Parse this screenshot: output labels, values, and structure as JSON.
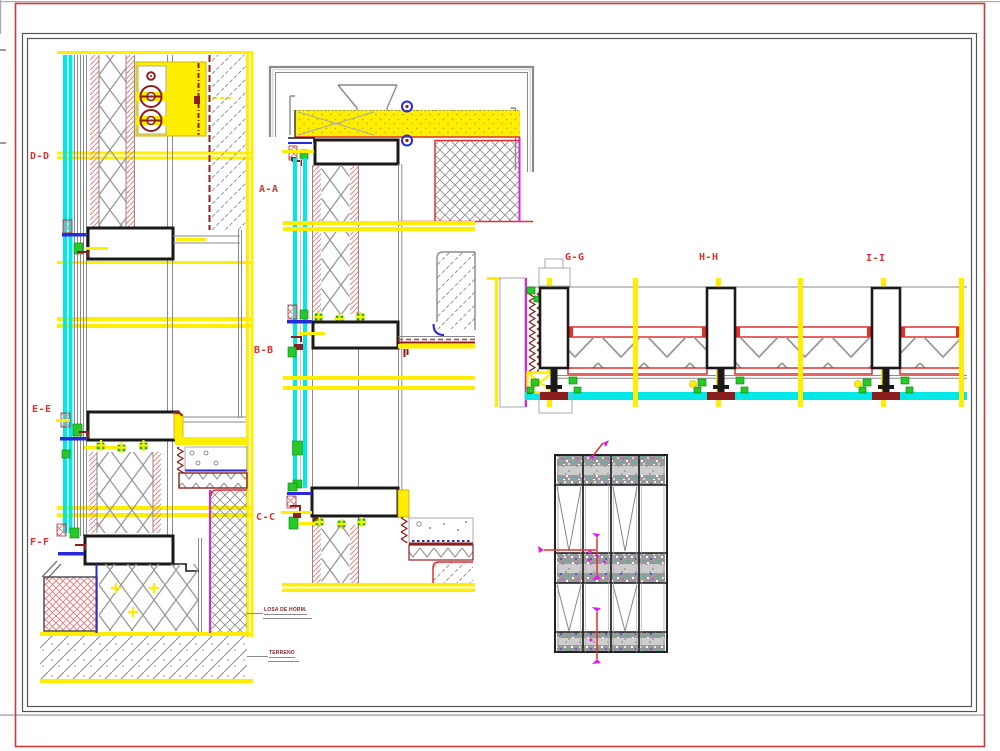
{
  "sheet": {
    "background": "#ffffff"
  },
  "frame": {
    "outer": "#cc3a3a",
    "inner": "#555555"
  },
  "section_labels": [
    {
      "id": "dd",
      "text": "D-D"
    },
    {
      "id": "aa",
      "text": "A-A"
    },
    {
      "id": "ee",
      "text": "E-E"
    },
    {
      "id": "bb",
      "text": "B-B"
    },
    {
      "id": "ff",
      "text": "F-F"
    },
    {
      "id": "cc",
      "text": "C-C"
    },
    {
      "id": "gg",
      "text": "G-G"
    },
    {
      "id": "hh",
      "text": "H-H"
    },
    {
      "id": "ii",
      "text": "I-I"
    }
  ],
  "annotations": [
    {
      "id": "losa",
      "text": "LOSA DE HORM."
    },
    {
      "id": "terreno",
      "text": "TERRENO"
    }
  ],
  "colors": {
    "bg": "#ffffff",
    "red": "#e03030",
    "dred": "#8b1f1f",
    "pink": "#e88484",
    "yellow": "#ffee00",
    "cyan": "#00e8e8",
    "green": "#28c828",
    "blue": "#2828dd",
    "magenta": "#dd22dd",
    "gray": "#8a8a8a",
    "black": "#1a1a1a",
    "framered": "#cc3a3a",
    "framegray": "#555555",
    "speckle": "#9a9a9a"
  }
}
